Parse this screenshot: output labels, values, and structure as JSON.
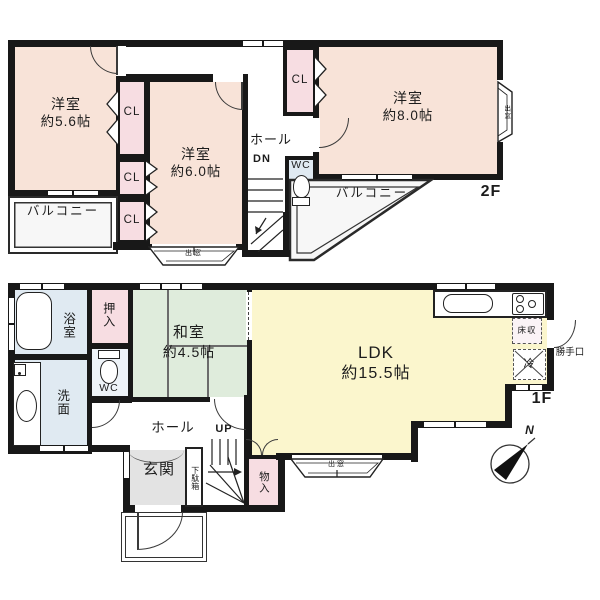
{
  "colors": {
    "wall": "#181818",
    "western_room_peach": "#f8e3d8",
    "closet_pink": "#f7dde2",
    "sanitary_blue": "#e0eaf2",
    "tatami_green": "#dfecdc",
    "ldk_yellow": "#fbf6cd",
    "entrance_gray": "#e3e3e3",
    "balcony_gray": "#f7f7f7"
  },
  "f2": {
    "floor_label": "2F",
    "room56_name": "洋室",
    "room56_size": "約5.6帖",
    "room60_name": "洋室",
    "room60_size": "約6.0帖",
    "room80_name": "洋室",
    "room80_size": "約8.0帖",
    "closet": "CL",
    "hall": "ホール",
    "down": "DN",
    "wc": "WC",
    "balcony": "バルコニー",
    "bay_window": "出窓"
  },
  "f1": {
    "floor_label": "1F",
    "bath": "浴室",
    "washroom": "洗面",
    "closet": "押入",
    "wc": "WC",
    "washitsu_name": "和室",
    "washitsu_size": "約4.5帖",
    "ldk_name": "LDK",
    "ldk_size": "約15.5帖",
    "hall": "ホール",
    "up": "UP",
    "entrance": "玄関",
    "shoe_cabinet": "下駄箱",
    "storage": "物入",
    "bay_window": "出窓",
    "floor_storage": "床収",
    "fridge": "冷",
    "back_door": "勝手口",
    "north": "N"
  }
}
